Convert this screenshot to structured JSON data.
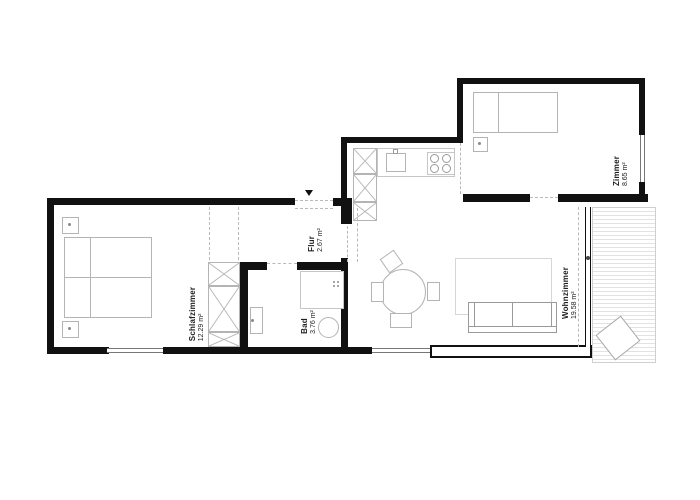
{
  "plan": {
    "title": "apartment-floor-plan",
    "rooms": {
      "schlafzimmer": {
        "name": "Schlafzimmer",
        "area": "12.29 m²"
      },
      "bad": {
        "name": "Bad",
        "area": "3.76 m²"
      },
      "flur": {
        "name": "Flur",
        "area": "2.67 m²"
      },
      "wohnzimmer": {
        "name": "Wohnzimmer",
        "area": "19.58 m²"
      },
      "zimmer": {
        "name": "Zimmer",
        "area": "8.65 m²"
      }
    },
    "colors": {
      "wall": "#111111",
      "furniture_outline": "#b4b4b4",
      "window_line": "#777777",
      "deck_line": "#e2e2e2",
      "text": "#222222"
    }
  }
}
